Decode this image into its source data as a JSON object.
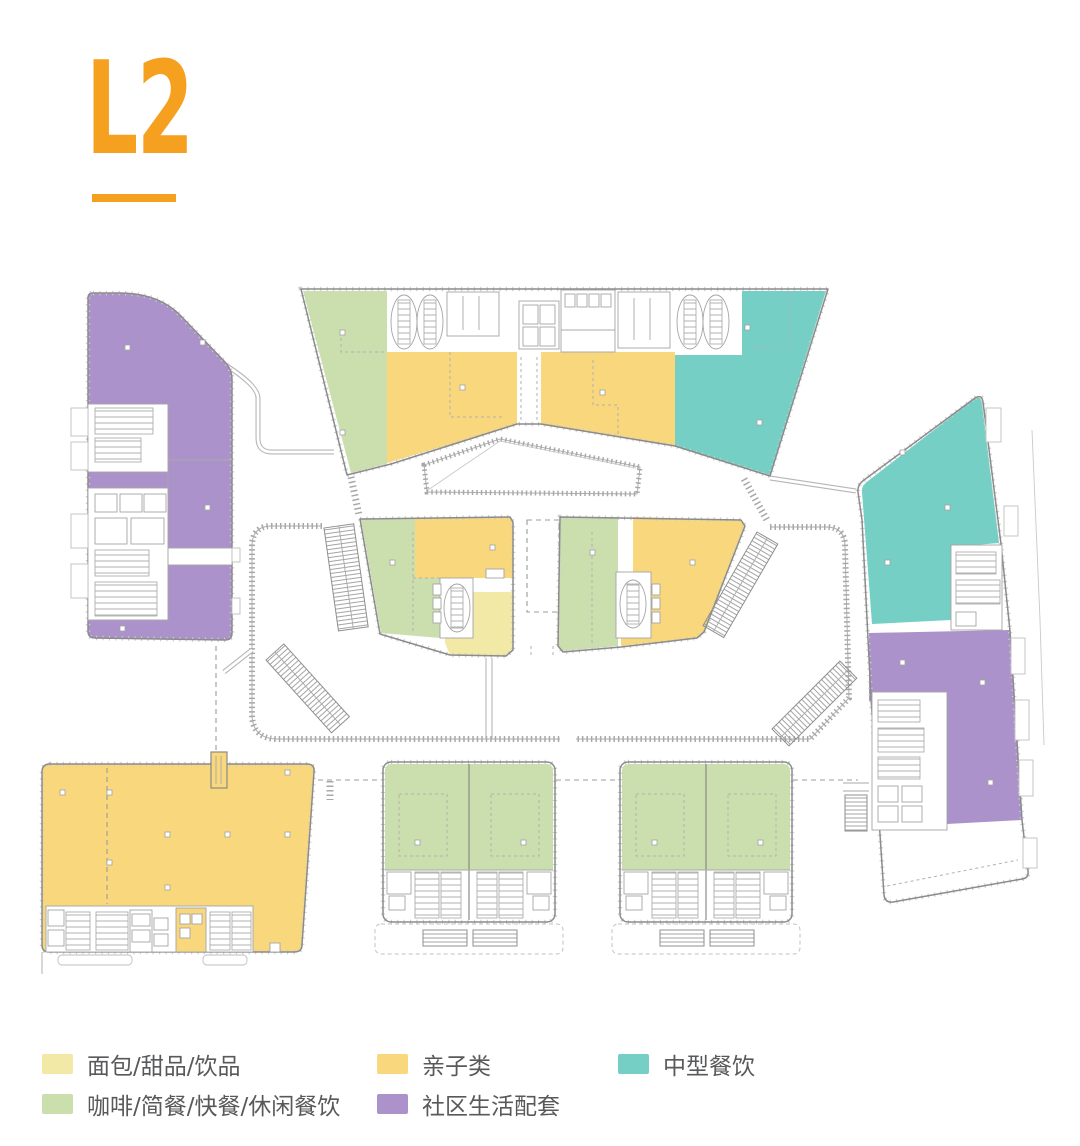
{
  "title": "L2",
  "colors": {
    "accent": "#F5A01F",
    "text": "#58595B",
    "outline": "#8B8B8B"
  },
  "palette": {
    "pale_yellow": "#F2E9A6",
    "green": "#CBDFAE",
    "gold": "#F8D77D",
    "teal": "#75CFC5",
    "purple": "#AC92CA"
  },
  "legend": {
    "items": [
      {
        "id": "pale-yellow",
        "label": "面包/甜品/饮品",
        "color": "#F2E9A6"
      },
      {
        "id": "gold",
        "label": "亲子类",
        "color": "#F8D77D"
      },
      {
        "id": "teal",
        "label": "中型餐饮",
        "color": "#75CFC5"
      },
      {
        "id": "green",
        "label": "咖啡/简餐/快餐/休闲餐饮",
        "color": "#CBDFAE"
      },
      {
        "id": "purple",
        "label": "社区生活配套",
        "color": "#AC92CA"
      }
    ]
  },
  "plan": {
    "floor": "L2",
    "blocks": [
      {
        "id": "north",
        "categories": [
          "咖啡/简餐/快餐/休闲餐饮",
          "亲子类",
          "中型餐饮"
        ]
      },
      {
        "id": "west",
        "categories": [
          "社区生活配套"
        ]
      },
      {
        "id": "east",
        "categories": [
          "中型餐饮",
          "社区生活配套"
        ]
      },
      {
        "id": "center-west",
        "categories": [
          "咖啡/简餐/快餐/休闲餐饮",
          "亲子类",
          "面包/甜品/饮品"
        ]
      },
      {
        "id": "center-east",
        "categories": [
          "咖啡/简餐/快餐/休闲餐饮",
          "亲子类"
        ]
      },
      {
        "id": "southwest",
        "categories": [
          "亲子类"
        ]
      },
      {
        "id": "south-a",
        "categories": [
          "咖啡/简餐/快餐/休闲餐饮"
        ]
      },
      {
        "id": "south-b",
        "categories": [
          "咖啡/简餐/快餐/休闲餐饮"
        ]
      }
    ]
  }
}
